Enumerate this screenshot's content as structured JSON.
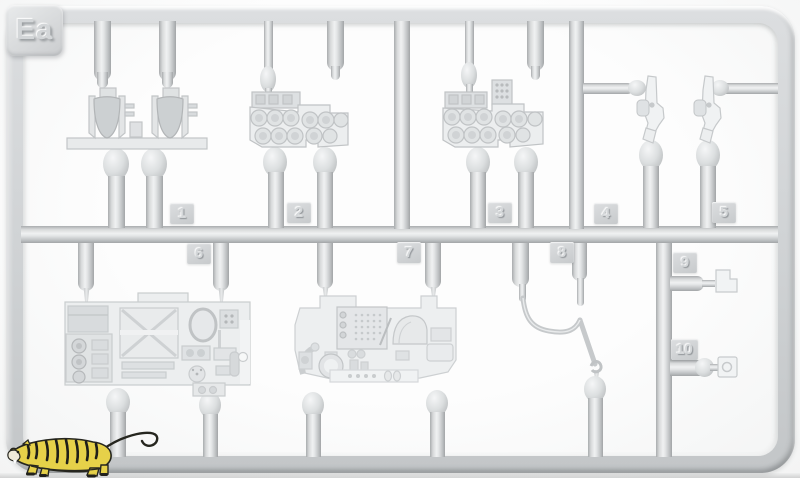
{
  "sprue": {
    "code": "Ea",
    "tags": [
      "1",
      "2",
      "3",
      "4",
      "5",
      "6",
      "7",
      "8",
      "9",
      "10"
    ]
  },
  "colors": {
    "plastic": "#d3d6d8",
    "background": "#fafafa",
    "tiger_body": "#e6d149",
    "tiger_stripes": "#23231e"
  },
  "watermark": {
    "name": "tiger logo"
  }
}
